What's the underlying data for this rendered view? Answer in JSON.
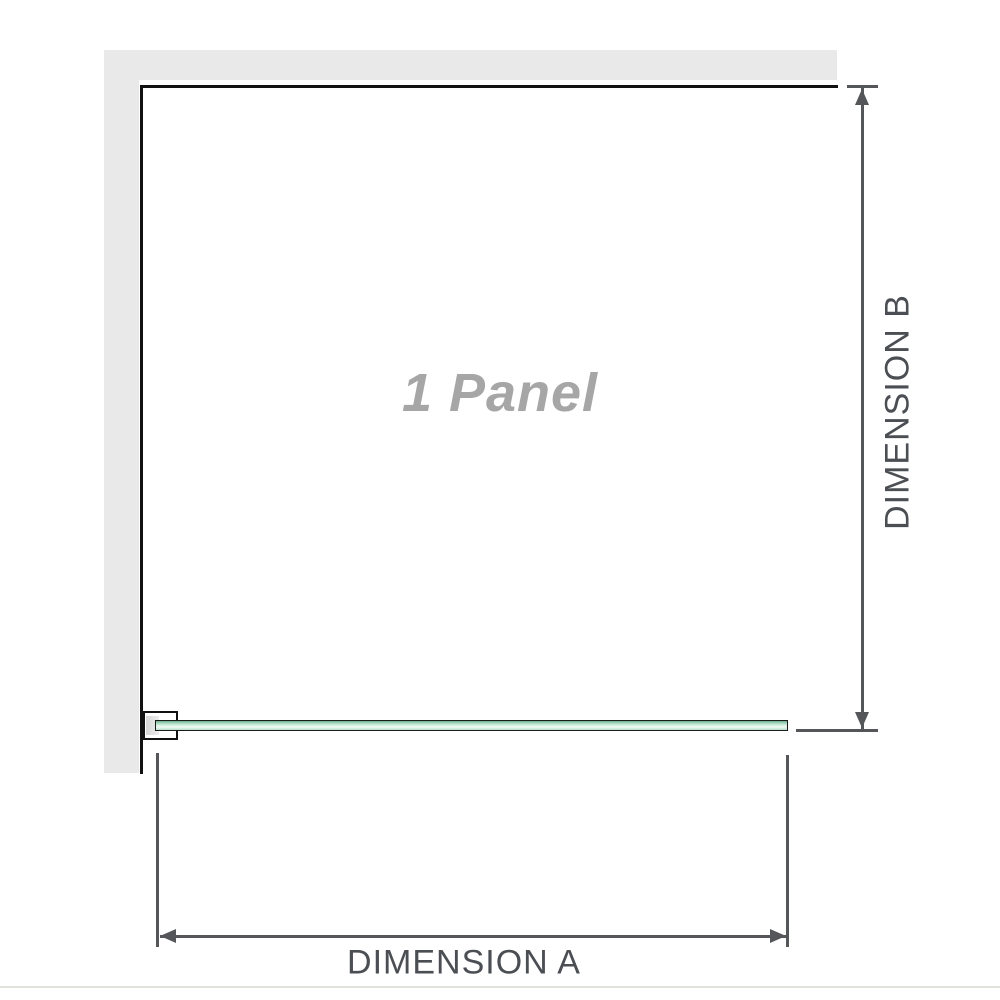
{
  "diagram": {
    "panel_label": "1 Panel",
    "dimension_a": {
      "label": "DIMENSION A"
    },
    "dimension_b": {
      "label": "DIMENSION B"
    }
  },
  "colors": {
    "background": "#ffffff",
    "wall": "#e9e9e9",
    "panel_outline": "#111111",
    "panel_text": "#a6a6a6",
    "glass_border": "#1a1a1a",
    "glass_dark": "#6fae8e",
    "glass_light": "#b3e0c9",
    "glass_highlight": "#e9f7f0",
    "bracket_fill": "#ffffff",
    "bracket_block": "#d7d7d7",
    "dim_line": "#54565a",
    "dim_text": "#4b4e53",
    "footer_line": "#e1e1dc"
  }
}
